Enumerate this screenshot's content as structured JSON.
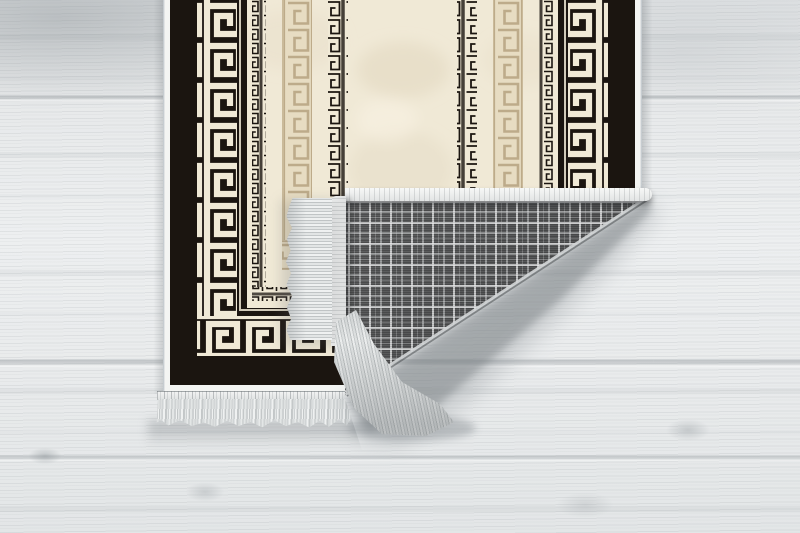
{
  "scene": {
    "description": "Product photo: black, cream and beige Greek-key (meander) patterned rug lying on a whitewashed wooden floor, bottom-right corner folded over to reveal a grey tartan plaid woven backing, white selvage edges and grey fringe tassels",
    "rug_pattern": "greek-key-meander",
    "backing_pattern": "grey-tartan-plaid",
    "floor": "light-whitewashed-wood-planks"
  },
  "colors": {
    "rug_black": "#1b1510",
    "rug_cream": "#f0e9d6",
    "beige_bg": "#e7dcc2",
    "beige_key": "#bdab8a",
    "selvage": "#f4f5f3",
    "fringe_light": "#eff1f1",
    "fringe_dark": "#c3c7c8",
    "plaid_base": "#4c4d4e",
    "plaid_line": "#dcdedf",
    "floor_base": "#e9ebec",
    "floor_shadow": "#6e7478"
  }
}
